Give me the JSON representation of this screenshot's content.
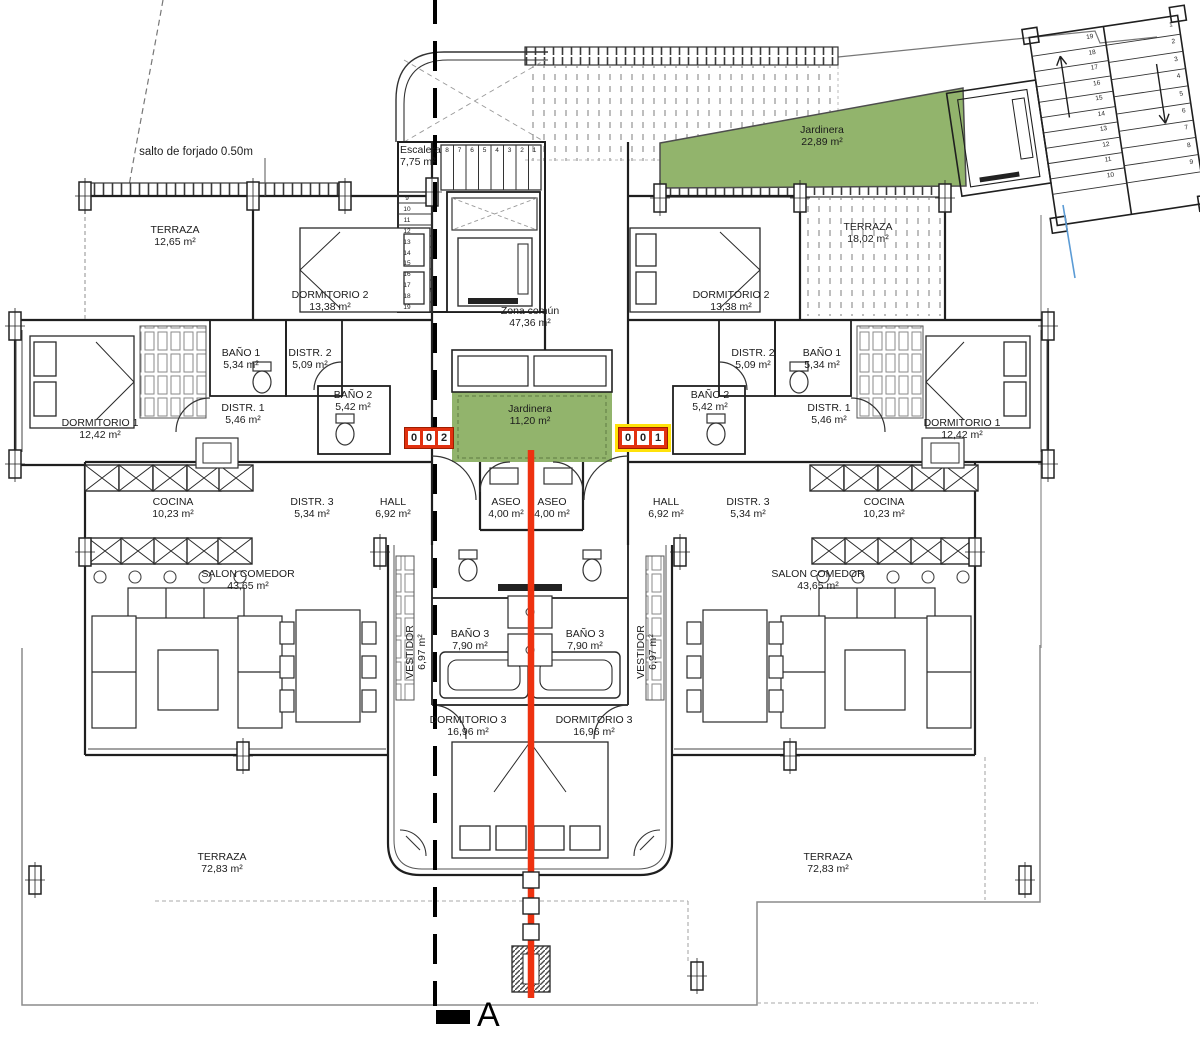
{
  "drawing": {
    "section_letter": "A",
    "salto_note": "salto de forjado 0.50m"
  },
  "badges": {
    "left": {
      "digits": [
        "0",
        "0",
        "2"
      ]
    },
    "right": {
      "digits": [
        "0",
        "0",
        "1"
      ]
    }
  },
  "colors": {
    "plan_green": "#92b46c",
    "green_edge": "#5d7a42",
    "section_red": "#ee3210",
    "badge_red": "#e23110",
    "badge_yellow": "#ffe20a",
    "ink": "#1f1f1f",
    "boundary_gray": "#8c8c8c",
    "blue_line": "#5b9bd5"
  },
  "rooms": {
    "terraza_nw": {
      "name": "TERRAZA",
      "area": "12,65 m²"
    },
    "dormitorio2_l": {
      "name": "DORMITORIO 2",
      "area": "13,38 m²"
    },
    "escalera": {
      "name": "Escalera",
      "area": "7,75 m²"
    },
    "zona_comun": {
      "name": "Zona común",
      "area": "47,36 m²"
    },
    "jardinera_top": {
      "name": "Jardinera",
      "area": "22,89 m²"
    },
    "terraza_ne": {
      "name": "TERRAZA",
      "area": "18,02 m²"
    },
    "dormitorio2_r": {
      "name": "DORMITORIO 2",
      "area": "13,38 m²"
    },
    "bano1_l": {
      "name": "BAÑO 1",
      "area": "5,34 m²"
    },
    "distr2_l": {
      "name": "DISTR. 2",
      "area": "5,09 m²"
    },
    "bano2_l": {
      "name": "BAÑO 2",
      "area": "5,42 m²"
    },
    "distr1_l": {
      "name": "DISTR. 1",
      "area": "5,46 m²"
    },
    "dormitorio1_l": {
      "name": "DORMITORIO 1",
      "area": "12,42 m²"
    },
    "jardinera_mid": {
      "name": "Jardinera",
      "area": "11,20 m²"
    },
    "distr2_r": {
      "name": "DISTR. 2",
      "area": "5,09 m²"
    },
    "bano1_r": {
      "name": "BAÑO 1",
      "area": "5,34 m²"
    },
    "bano2_r": {
      "name": "BAÑO 2",
      "area": "5,42 m²"
    },
    "distr1_r": {
      "name": "DISTR. 1",
      "area": "5,46 m²"
    },
    "dormitorio1_r": {
      "name": "DORMITORIO 1",
      "area": "12,42 m²"
    },
    "cocina_l": {
      "name": "COCINA",
      "area": "10,23 m²"
    },
    "distr3_l": {
      "name": "DISTR. 3",
      "area": "5,34 m²"
    },
    "hall_l": {
      "name": "HALL",
      "area": "6,92 m²"
    },
    "aseo_l": {
      "name": "ASEO",
      "area": "4,00 m²"
    },
    "aseo_r": {
      "name": "ASEO",
      "area": "4,00 m²"
    },
    "hall_r": {
      "name": "HALL",
      "area": "6,92 m²"
    },
    "distr3_r": {
      "name": "DISTR. 3",
      "area": "5,34 m²"
    },
    "cocina_r": {
      "name": "COCINA",
      "area": "10,23 m²"
    },
    "salon_l": {
      "name": "SALON COMEDOR",
      "area": "43,65 m²"
    },
    "salon_r": {
      "name": "SALON COMEDOR",
      "area": "43,65 m²"
    },
    "vestidor_l": {
      "name": "VESTIDOR",
      "area": "6,97 m²"
    },
    "vestidor_r": {
      "name": "VESTIDOR",
      "area": "6,97 m²"
    },
    "bano3_l": {
      "name": "BAÑO 3",
      "area": "7,90 m²"
    },
    "bano3_r": {
      "name": "BAÑO 3",
      "area": "7,90 m²"
    },
    "dormitorio3_l": {
      "name": "DORMITORIO 3",
      "area": "16,96 m²"
    },
    "dormitorio3_r": {
      "name": "DORMITORIO 3",
      "area": "16,96 m²"
    },
    "terraza_sw": {
      "name": "TERRAZA",
      "area": "72,83 m²"
    },
    "terraza_se": {
      "name": "TERRAZA",
      "area": "72,83 m²"
    }
  },
  "stairs": {
    "top_row": [
      "8",
      "7",
      "6",
      "5",
      "4",
      "3",
      "2",
      "1"
    ],
    "left_col": [
      "9",
      "10",
      "11",
      "12",
      "13",
      "14",
      "15",
      "16",
      "17",
      "18",
      "19"
    ],
    "ne_left": [
      "19",
      "18",
      "17",
      "16",
      "15",
      "14",
      "13",
      "12",
      "11",
      "10"
    ],
    "ne_right": [
      "1",
      "2",
      "3",
      "4",
      "5",
      "6",
      "7",
      "8",
      "9"
    ]
  }
}
